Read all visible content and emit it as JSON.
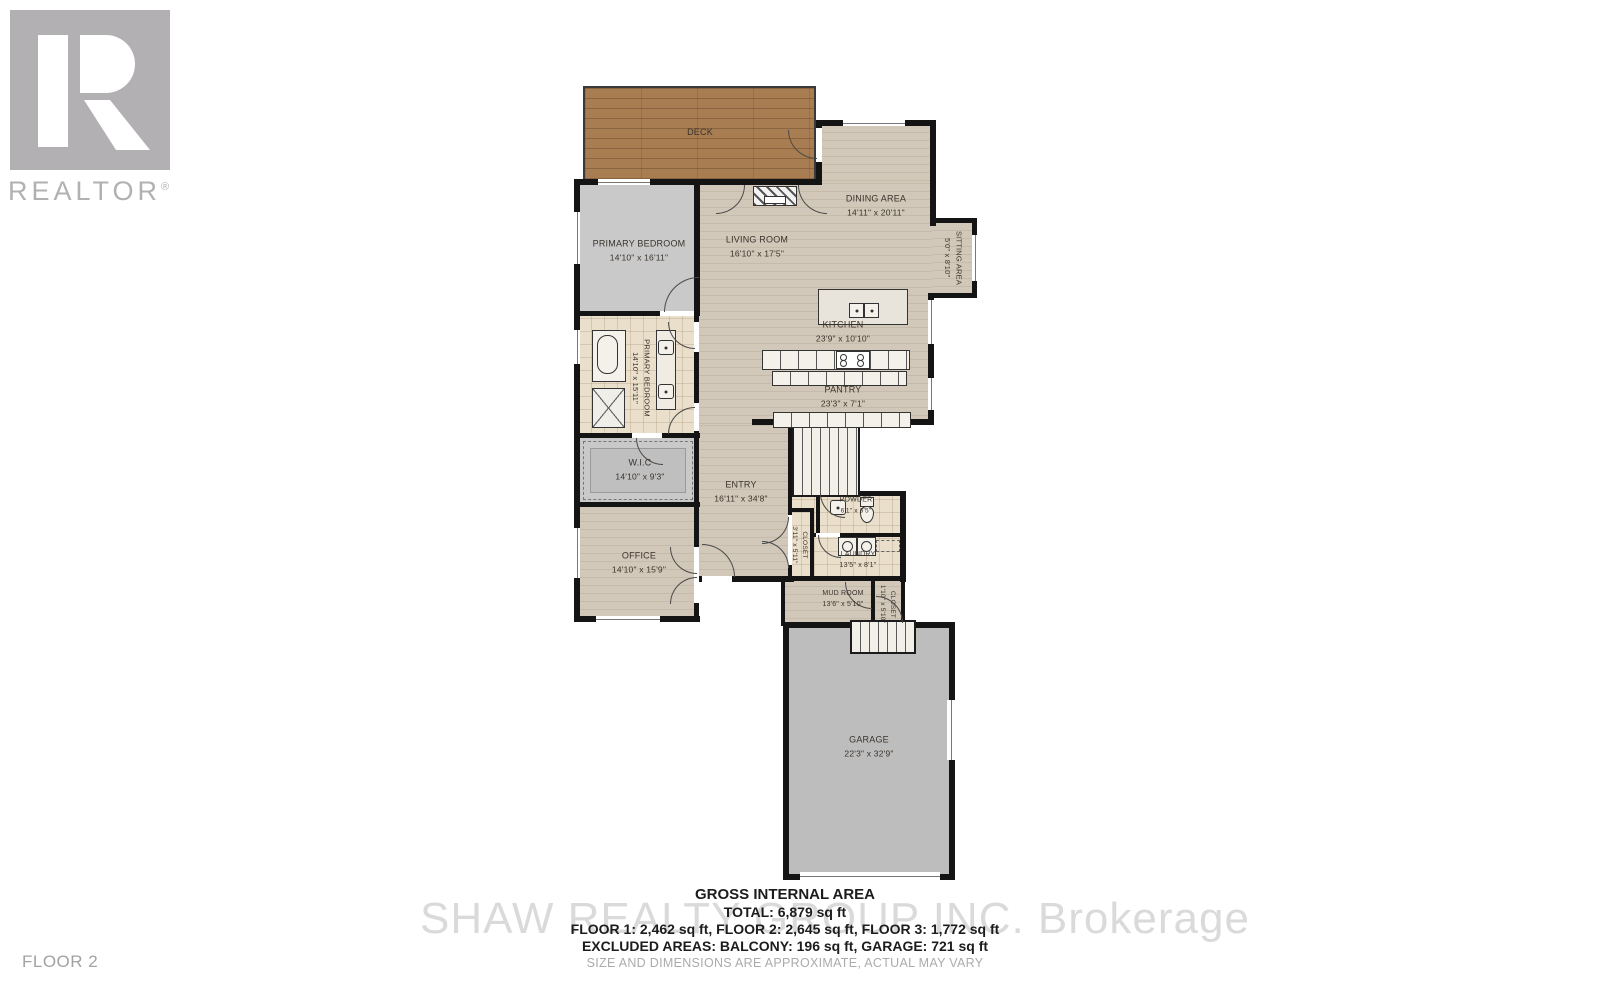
{
  "logo": {
    "text": "REALTOR",
    "reg": "®"
  },
  "floor_label": "FLOOR 2",
  "watermark": "SHAW REALTY GROUP INC. Brokerage",
  "rooms": {
    "deck": {
      "name": "DECK",
      "dims": ""
    },
    "primary_bedroom": {
      "name": "PRIMARY BEDROOM",
      "dims": "14'10\" x 16'11\""
    },
    "living_room": {
      "name": "LIVING ROOM",
      "dims": "16'10\" x 17'5\""
    },
    "dining_area": {
      "name": "DINING AREA",
      "dims": "14'11\" x 20'11\""
    },
    "sitting_area": {
      "name": "SITTING AREA",
      "dims": "5'0\" x 8'10\""
    },
    "kitchen": {
      "name": "KITCHEN",
      "dims": "23'9\" x 10'10\""
    },
    "pantry": {
      "name": "PANTRY",
      "dims": "23'3\" x 7'1\""
    },
    "primary_bath": {
      "name": "PRIMARY BEDROOM",
      "dims": "14'10\" x 15'11\""
    },
    "wic": {
      "name": "W.I.C",
      "dims": "14'10\" x 9'3\""
    },
    "office": {
      "name": "OFFICE",
      "dims": "14'10\" x 15'9\""
    },
    "entry": {
      "name": "ENTRY",
      "dims": "16'11\" x 34'8\""
    },
    "powder": {
      "name": "POWDER",
      "dims": "6'1\" x 6'5\""
    },
    "closet_hall": {
      "name": "CLOSET",
      "dims": "3'11\" x 5'11\""
    },
    "laundry": {
      "name": "LAUNDRY",
      "dims": "13'5\" x 8'1\""
    },
    "mud_room": {
      "name": "MUD ROOM",
      "dims": "13'6\" x 5'10\""
    },
    "closet_mud": {
      "name": "CLOSET",
      "dims": "1'10\" x 5'10\""
    },
    "garage": {
      "name": "GARAGE",
      "dims": "22'3\" x 32'9\""
    }
  },
  "summary": {
    "title": "GROSS INTERNAL AREA",
    "total": "TOTAL: 6,879 sq ft",
    "floors": "FLOOR 1: 2,462 sq ft, FLOOR 2: 2,645 sq ft, FLOOR 3: 1,772 sq ft",
    "excluded": "EXCLUDED AREAS: BALCONY: 196 sq ft, GARAGE: 721 sq ft",
    "disclaimer": "SIZE AND DIMENSIONS ARE APPROXIMATE, ACTUAL MAY VARY"
  }
}
